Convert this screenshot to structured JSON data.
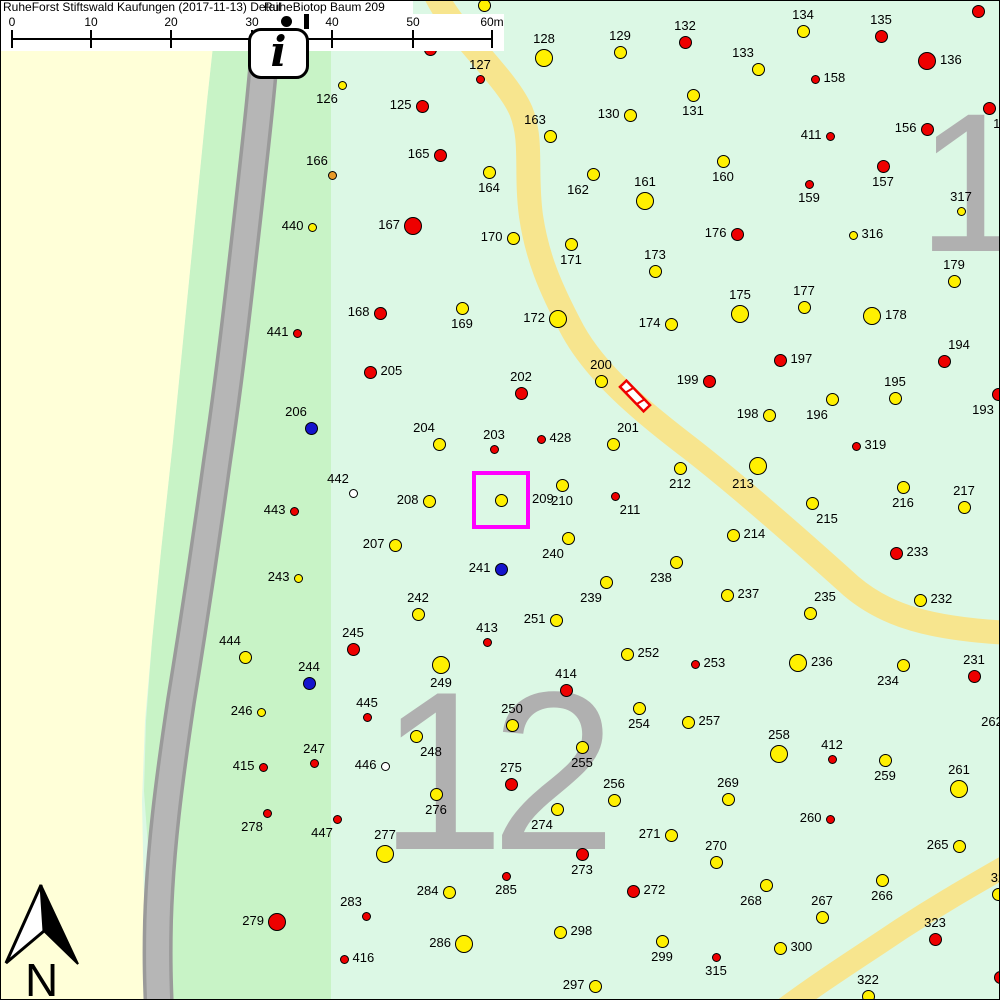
{
  "header": {
    "title_left": "RuheForst Stiftswald Kaufungen (2017-11-13) Detail",
    "title_right": "RuheBiotop Baum 209"
  },
  "scale_bar": {
    "labels": [
      "0",
      "10",
      "20",
      "30",
      "40",
      "50",
      "60m"
    ],
    "tick_x": [
      11,
      90,
      170,
      251,
      331,
      412,
      491
    ]
  },
  "info_icon_glyph": "i",
  "north_label": "N",
  "compartments": {
    "right": "1",
    "bottom": "12"
  },
  "highlight": {
    "tree": "209",
    "x": 471,
    "y": 470,
    "size": 58,
    "color": "#FF00FF"
  },
  "colors": {
    "yellow": "#FFF000",
    "red": "#EE0000",
    "blue": "#1414CC",
    "orange": "#E89A28",
    "white": "#FFFFFF",
    "mint": "#DCF8E5",
    "band_green": "#C8F3C6",
    "pale_yellow": "#FFFFD8",
    "road_fill": "#B6B6B6",
    "road_edge": "#9A9A9A",
    "trail": "#F7E58E",
    "compartment_gray": "#B0B0B0"
  },
  "trees": [
    [
      "",
      483,
      4,
      "yellow",
      "m",
      "-"
    ],
    [
      "",
      429,
      48,
      "red",
      "m",
      "-"
    ],
    [
      "127",
      479,
      78,
      "red",
      "s",
      "a"
    ],
    [
      "128",
      543,
      57,
      "yellow",
      "l",
      "a"
    ],
    [
      "129",
      619,
      51,
      "yellow",
      "m",
      "a"
    ],
    [
      "126",
      341,
      84,
      "yellow",
      "s",
      "bl"
    ],
    [
      "125",
      421,
      105,
      "red",
      "m",
      "l"
    ],
    [
      "130",
      629,
      114,
      "yellow",
      "m",
      "l"
    ],
    [
      "132",
      684,
      41,
      "red",
      "m",
      "a"
    ],
    [
      "134",
      802,
      30,
      "yellow",
      "m",
      "a"
    ],
    [
      "135",
      880,
      35,
      "red",
      "m",
      "a"
    ],
    [
      "",
      977,
      10,
      "red",
      "m",
      "-"
    ],
    [
      "136",
      926,
      60,
      "red",
      "l",
      "r"
    ],
    [
      "158",
      814,
      78,
      "red",
      "s",
      "r"
    ],
    [
      "133",
      757,
      68,
      "yellow",
      "m",
      "al"
    ],
    [
      "131",
      692,
      94,
      "yellow",
      "m",
      "b"
    ],
    [
      "156",
      926,
      128,
      "red",
      "m",
      "l"
    ],
    [
      "155",
      988,
      107,
      "red",
      "m",
      "br"
    ],
    [
      "411",
      829,
      135,
      "red",
      "s",
      "l"
    ],
    [
      "160",
      722,
      160,
      "yellow",
      "m",
      "b"
    ],
    [
      "157",
      882,
      165,
      "red",
      "m",
      "b"
    ],
    [
      "159",
      808,
      183,
      "red",
      "s",
      "b"
    ],
    [
      "317",
      960,
      210,
      "yellow",
      "s",
      "a"
    ],
    [
      "166",
      331,
      174,
      "orange",
      "s",
      "al"
    ],
    [
      "163",
      549,
      135,
      "yellow",
      "m",
      "al"
    ],
    [
      "165",
      439,
      154,
      "red",
      "m",
      "l"
    ],
    [
      "164",
      488,
      171,
      "yellow",
      "m",
      "b"
    ],
    [
      "162",
      592,
      173,
      "yellow",
      "m",
      "bl"
    ],
    [
      "161",
      644,
      200,
      "yellow",
      "l",
      "a"
    ],
    [
      "440",
      311,
      226,
      "yellow",
      "s",
      "l"
    ],
    [
      "167",
      412,
      225,
      "red",
      "l",
      "l"
    ],
    [
      "170",
      512,
      237,
      "yellow",
      "m",
      "l"
    ],
    [
      "171",
      570,
      243,
      "yellow",
      "m",
      "b"
    ],
    [
      "176",
      736,
      233,
      "red",
      "m",
      "l"
    ],
    [
      "316",
      852,
      234,
      "yellow",
      "s",
      "r"
    ],
    [
      "173",
      654,
      270,
      "yellow",
      "m",
      "a"
    ],
    [
      "179",
      953,
      280,
      "yellow",
      "m",
      "a"
    ],
    [
      "175",
      739,
      313,
      "yellow",
      "l",
      "a"
    ],
    [
      "177",
      803,
      306,
      "yellow",
      "m",
      "a"
    ],
    [
      "178",
      871,
      315,
      "yellow",
      "l",
      "r"
    ],
    [
      "174",
      670,
      323,
      "yellow",
      "m",
      "l"
    ],
    [
      "441",
      296,
      332,
      "red",
      "s",
      "l"
    ],
    [
      "168",
      379,
      312,
      "red",
      "m",
      "l"
    ],
    [
      "169",
      461,
      307,
      "yellow",
      "m",
      "b"
    ],
    [
      "172",
      557,
      318,
      "yellow",
      "l",
      "l"
    ],
    [
      "205",
      369,
      371,
      "red",
      "m",
      "r"
    ],
    [
      "202",
      520,
      392,
      "red",
      "m",
      "a"
    ],
    [
      "200",
      600,
      380,
      "yellow",
      "m",
      "a"
    ],
    [
      "199",
      708,
      380,
      "red",
      "m",
      "l"
    ],
    [
      "197",
      779,
      359,
      "red",
      "m",
      "r"
    ],
    [
      "194",
      943,
      360,
      "red",
      "m",
      "ar"
    ],
    [
      "195",
      894,
      397,
      "yellow",
      "m",
      "a"
    ],
    [
      "196",
      831,
      398,
      "yellow",
      "m",
      "bl"
    ],
    [
      "198",
      768,
      414,
      "yellow",
      "m",
      "l"
    ],
    [
      "319",
      855,
      445,
      "red",
      "s",
      "r"
    ],
    [
      "193",
      997,
      393,
      "red",
      "m",
      "bl"
    ],
    [
      "204",
      438,
      443,
      "yellow",
      "m",
      "al"
    ],
    [
      "203",
      493,
      448,
      "red",
      "s",
      "a"
    ],
    [
      "428",
      540,
      438,
      "red",
      "s",
      "r"
    ],
    [
      "201",
      612,
      443,
      "yellow",
      "m",
      "ar"
    ],
    [
      "211",
      614,
      495,
      "red",
      "s",
      "br"
    ],
    [
      "212",
      679,
      467,
      "yellow",
      "m",
      "b"
    ],
    [
      "213",
      757,
      465,
      "yellow",
      "l",
      "bl"
    ],
    [
      "206",
      310,
      427,
      "blue",
      "m",
      "al"
    ],
    [
      "442",
      352,
      492,
      "white",
      "s",
      "al"
    ],
    [
      "443",
      293,
      510,
      "red",
      "s",
      "l"
    ],
    [
      "208",
      428,
      500,
      "yellow",
      "m",
      "l"
    ],
    [
      "209",
      500,
      499,
      "yellow",
      "m",
      "R"
    ],
    [
      "210",
      561,
      484,
      "yellow",
      "m",
      "b"
    ],
    [
      "240",
      567,
      537,
      "yellow",
      "m",
      "bl"
    ],
    [
      "214",
      732,
      534,
      "yellow",
      "m",
      "r"
    ],
    [
      "233",
      895,
      552,
      "red",
      "m",
      "r"
    ],
    [
      "216",
      902,
      486,
      "yellow",
      "m",
      "b"
    ],
    [
      "215",
      811,
      502,
      "yellow",
      "m",
      "br"
    ],
    [
      "217",
      963,
      506,
      "yellow",
      "m",
      "a"
    ],
    [
      "207",
      394,
      544,
      "yellow",
      "m",
      "l"
    ],
    [
      "241",
      500,
      568,
      "blue",
      "m",
      "l"
    ],
    [
      "238",
      675,
      561,
      "yellow",
      "m",
      "bl"
    ],
    [
      "243",
      297,
      577,
      "yellow",
      "s",
      "l"
    ],
    [
      "237",
      726,
      594,
      "yellow",
      "m",
      "r"
    ],
    [
      "235",
      809,
      612,
      "yellow",
      "m",
      "ar"
    ],
    [
      "232",
      919,
      599,
      "yellow",
      "m",
      "r"
    ],
    [
      "242",
      417,
      613,
      "yellow",
      "m",
      "a"
    ],
    [
      "251",
      555,
      619,
      "yellow",
      "m",
      "l"
    ],
    [
      "239",
      605,
      581,
      "yellow",
      "m",
      "bl"
    ],
    [
      "236",
      797,
      662,
      "yellow",
      "l",
      "r"
    ],
    [
      "234",
      902,
      664,
      "yellow",
      "m",
      "bl"
    ],
    [
      "231",
      973,
      675,
      "red",
      "m",
      "a"
    ],
    [
      "444",
      244,
      656,
      "yellow",
      "m",
      "al"
    ],
    [
      "245",
      352,
      648,
      "red",
      "m",
      "a"
    ],
    [
      "244",
      308,
      682,
      "blue",
      "m",
      "a"
    ],
    [
      "249",
      440,
      664,
      "yellow",
      "l",
      "b"
    ],
    [
      "413",
      486,
      641,
      "red",
      "s",
      "a"
    ],
    [
      "252",
      626,
      653,
      "yellow",
      "m",
      "r"
    ],
    [
      "253",
      694,
      663,
      "red",
      "s",
      "r"
    ],
    [
      "414",
      565,
      689,
      "red",
      "m",
      "a"
    ],
    [
      "254",
      638,
      707,
      "yellow",
      "m",
      "b"
    ],
    [
      "257",
      687,
      721,
      "yellow",
      "m",
      "r"
    ],
    [
      "250",
      511,
      724,
      "yellow",
      "m",
      "a"
    ],
    [
      "246",
      260,
      711,
      "yellow",
      "s",
      "l"
    ],
    [
      "445",
      366,
      716,
      "red",
      "s",
      "a"
    ],
    [
      "248",
      415,
      735,
      "yellow",
      "m",
      "br"
    ],
    [
      "255",
      581,
      746,
      "yellow",
      "m",
      "b"
    ],
    [
      "247",
      313,
      762,
      "red",
      "s",
      "a"
    ],
    [
      "415",
      262,
      766,
      "red",
      "s",
      "l"
    ],
    [
      "446",
      384,
      765,
      "white",
      "s",
      "l"
    ],
    [
      "275",
      510,
      783,
      "red",
      "m",
      "a"
    ],
    [
      "258",
      778,
      753,
      "yellow",
      "l",
      "a"
    ],
    [
      "412",
      831,
      758,
      "red",
      "s",
      "a"
    ],
    [
      "259",
      884,
      759,
      "yellow",
      "m",
      "b"
    ],
    [
      "261",
      958,
      788,
      "yellow",
      "l",
      "a"
    ],
    [
      "262",
      1006,
      737,
      "yellow",
      "m",
      "al"
    ],
    [
      "276",
      435,
      793,
      "yellow",
      "m",
      "b"
    ],
    [
      "269",
      727,
      798,
      "yellow",
      "m",
      "a"
    ],
    [
      "256",
      613,
      799,
      "yellow",
      "m",
      "a"
    ],
    [
      "260",
      829,
      818,
      "red",
      "s",
      "l"
    ],
    [
      "271",
      670,
      834,
      "yellow",
      "m",
      "l"
    ],
    [
      "270",
      715,
      861,
      "yellow",
      "m",
      "a"
    ],
    [
      "265",
      958,
      845,
      "yellow",
      "m",
      "l"
    ],
    [
      "278",
      266,
      812,
      "red",
      "s",
      "bl"
    ],
    [
      "447",
      336,
      818,
      "red",
      "s",
      "bl"
    ],
    [
      "277",
      384,
      853,
      "yellow",
      "l",
      "a"
    ],
    [
      "274",
      556,
      808,
      "yellow",
      "m",
      "bl"
    ],
    [
      "273",
      581,
      853,
      "red",
      "m",
      "b"
    ],
    [
      "272",
      632,
      890,
      "red",
      "m",
      "r"
    ],
    [
      "285",
      505,
      875,
      "red",
      "s",
      "b"
    ],
    [
      "284",
      448,
      891,
      "yellow",
      "m",
      "l"
    ],
    [
      "283",
      365,
      915,
      "red",
      "s",
      "al"
    ],
    [
      "298",
      559,
      931,
      "yellow",
      "m",
      "r"
    ],
    [
      "299",
      661,
      940,
      "yellow",
      "m",
      "b"
    ],
    [
      "286",
      463,
      943,
      "yellow",
      "l",
      "l"
    ],
    [
      "416",
      343,
      958,
      "red",
      "s",
      "r"
    ],
    [
      "297",
      594,
      985,
      "yellow",
      "m",
      "l"
    ],
    [
      "279",
      276,
      921,
      "red",
      "l",
      "l"
    ],
    [
      "266",
      881,
      879,
      "yellow",
      "m",
      "b"
    ],
    [
      "268",
      765,
      884,
      "yellow",
      "m",
      "bl"
    ],
    [
      "267",
      821,
      916,
      "yellow",
      "m",
      "a"
    ],
    [
      "323",
      934,
      938,
      "red",
      "m",
      "a"
    ],
    [
      "300",
      779,
      947,
      "yellow",
      "m",
      "r"
    ],
    [
      "315",
      715,
      956,
      "red",
      "s",
      "b"
    ],
    [
      "322",
      867,
      995,
      "yellow",
      "m",
      "a"
    ],
    [
      "32",
      997,
      893,
      "yellow",
      "m",
      "a"
    ],
    [
      "",
      999,
      976,
      "red",
      "m",
      "-"
    ]
  ]
}
